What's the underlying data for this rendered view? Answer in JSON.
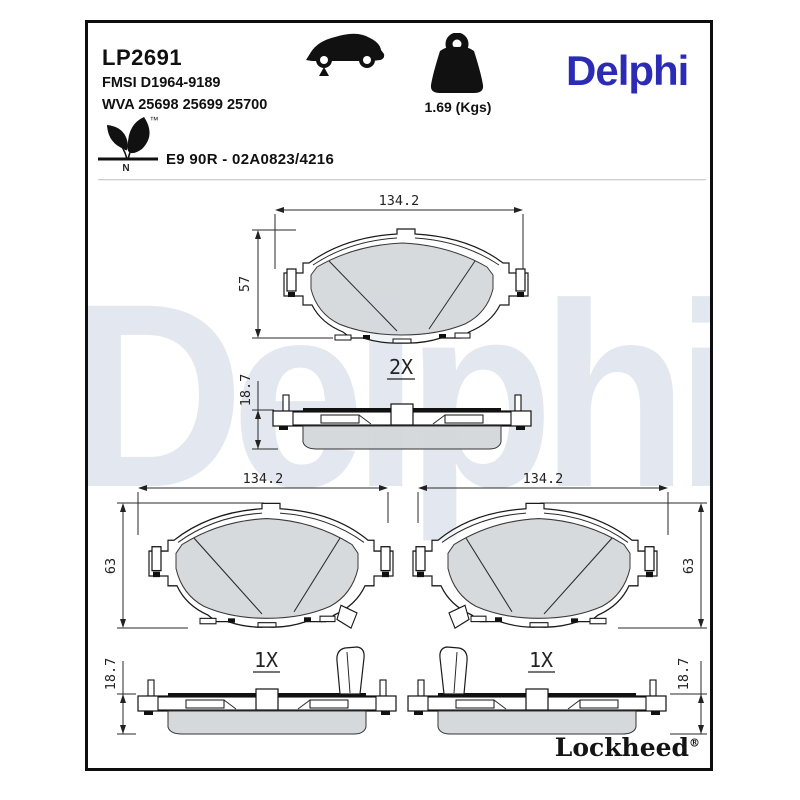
{
  "header": {
    "part_number": "LP2691",
    "fmsi": "FMSI D1964-9189",
    "wva": "WVA 25698 25699 25700",
    "weight": "1.69 (Kgs)",
    "brand_logo": "Delphi",
    "homologation": "E9 90R - 02A0823/4216",
    "leaf_trademark": "™",
    "leaf_letter": "N"
  },
  "watermark": "Delphi",
  "footer": {
    "logo": "Lockheed",
    "registered": "®"
  },
  "dimensions": {
    "fv1_width": "134.2",
    "fv1_height": "57",
    "sv1_qty": "2X",
    "sv1_thickness": "18.7",
    "fv2_width": "134.2",
    "fv2_height": "63",
    "fv3_width": "134.2",
    "fv3_height": "63",
    "sv2_qty": "1X",
    "sv2_thickness": "18.7",
    "sv3_qty": "1X",
    "sv3_thickness": "18.7"
  },
  "colors": {
    "brand_blue": "#2b2bb5",
    "watermark_gray": "#e3e8f0",
    "friction_gray": "#d3d6d9",
    "line_black": "#1a1a1a"
  }
}
